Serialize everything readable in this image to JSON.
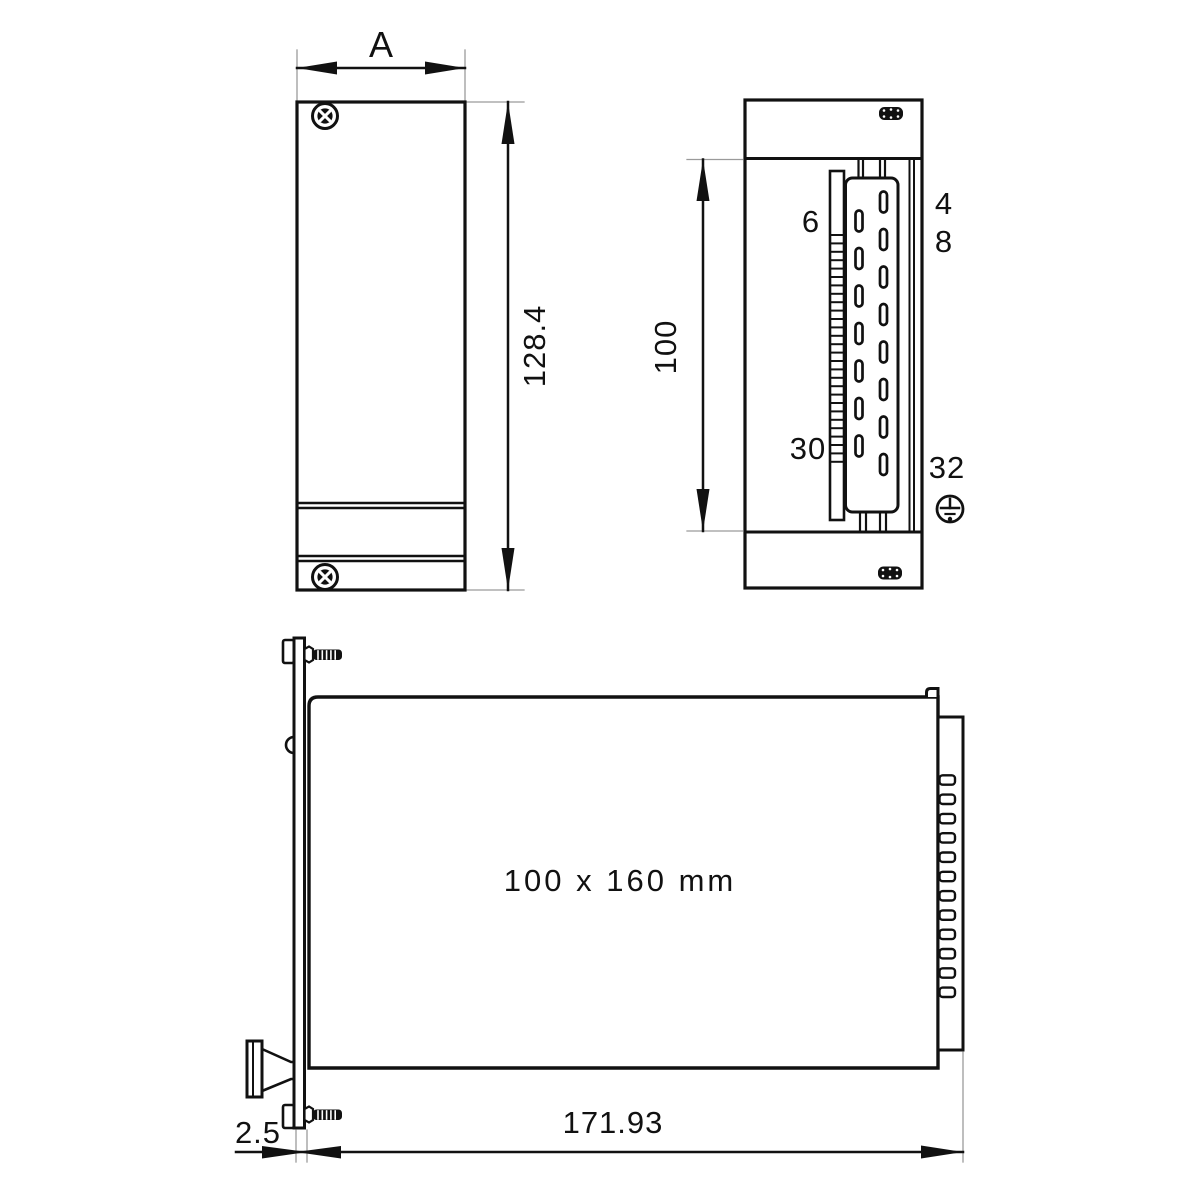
{
  "drawing": {
    "front_view": {
      "width_label": "A",
      "height_label": "128.4"
    },
    "rear_view": {
      "height_label": "100",
      "pin_top_left": "6",
      "pin_right_top": "4",
      "pin_right_second": "8",
      "pin_bottom_left": "30",
      "pin_bottom_right": "32"
    },
    "side_view": {
      "board_size_label": "100 x 160 mm",
      "length_label": "171.93",
      "panel_thickness_label": "2.5"
    }
  },
  "colors": {
    "line": "#111111",
    "thin_line": "#9a9a9a",
    "background": "#ffffff"
  }
}
